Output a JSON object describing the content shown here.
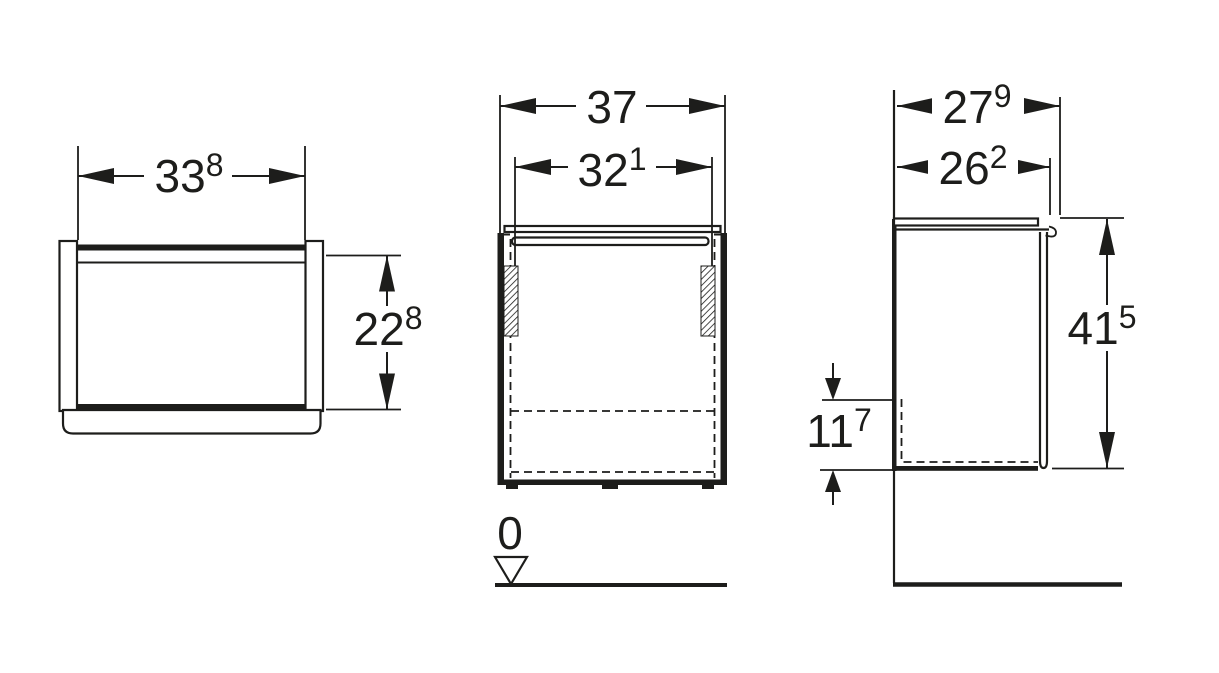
{
  "drawing": {
    "background_color": "#ffffff",
    "line_color": "#1d1d1b",
    "views": {
      "front_view": {
        "width": {
          "value": "33",
          "sup": "8"
        },
        "height": {
          "value": "22",
          "sup": "8"
        }
      },
      "plan_view": {
        "overall_width": {
          "value": "37",
          "sup": ""
        },
        "internal_width": {
          "value": "32",
          "sup": "1"
        },
        "datum": "0"
      },
      "side_view": {
        "overall_depth": {
          "value": "27",
          "sup": "9"
        },
        "internal_depth": {
          "value": "26",
          "sup": "2"
        },
        "height": {
          "value": "41",
          "sup": "5"
        },
        "bottom_clearance": {
          "value": "11",
          "sup": "7"
        }
      }
    }
  }
}
